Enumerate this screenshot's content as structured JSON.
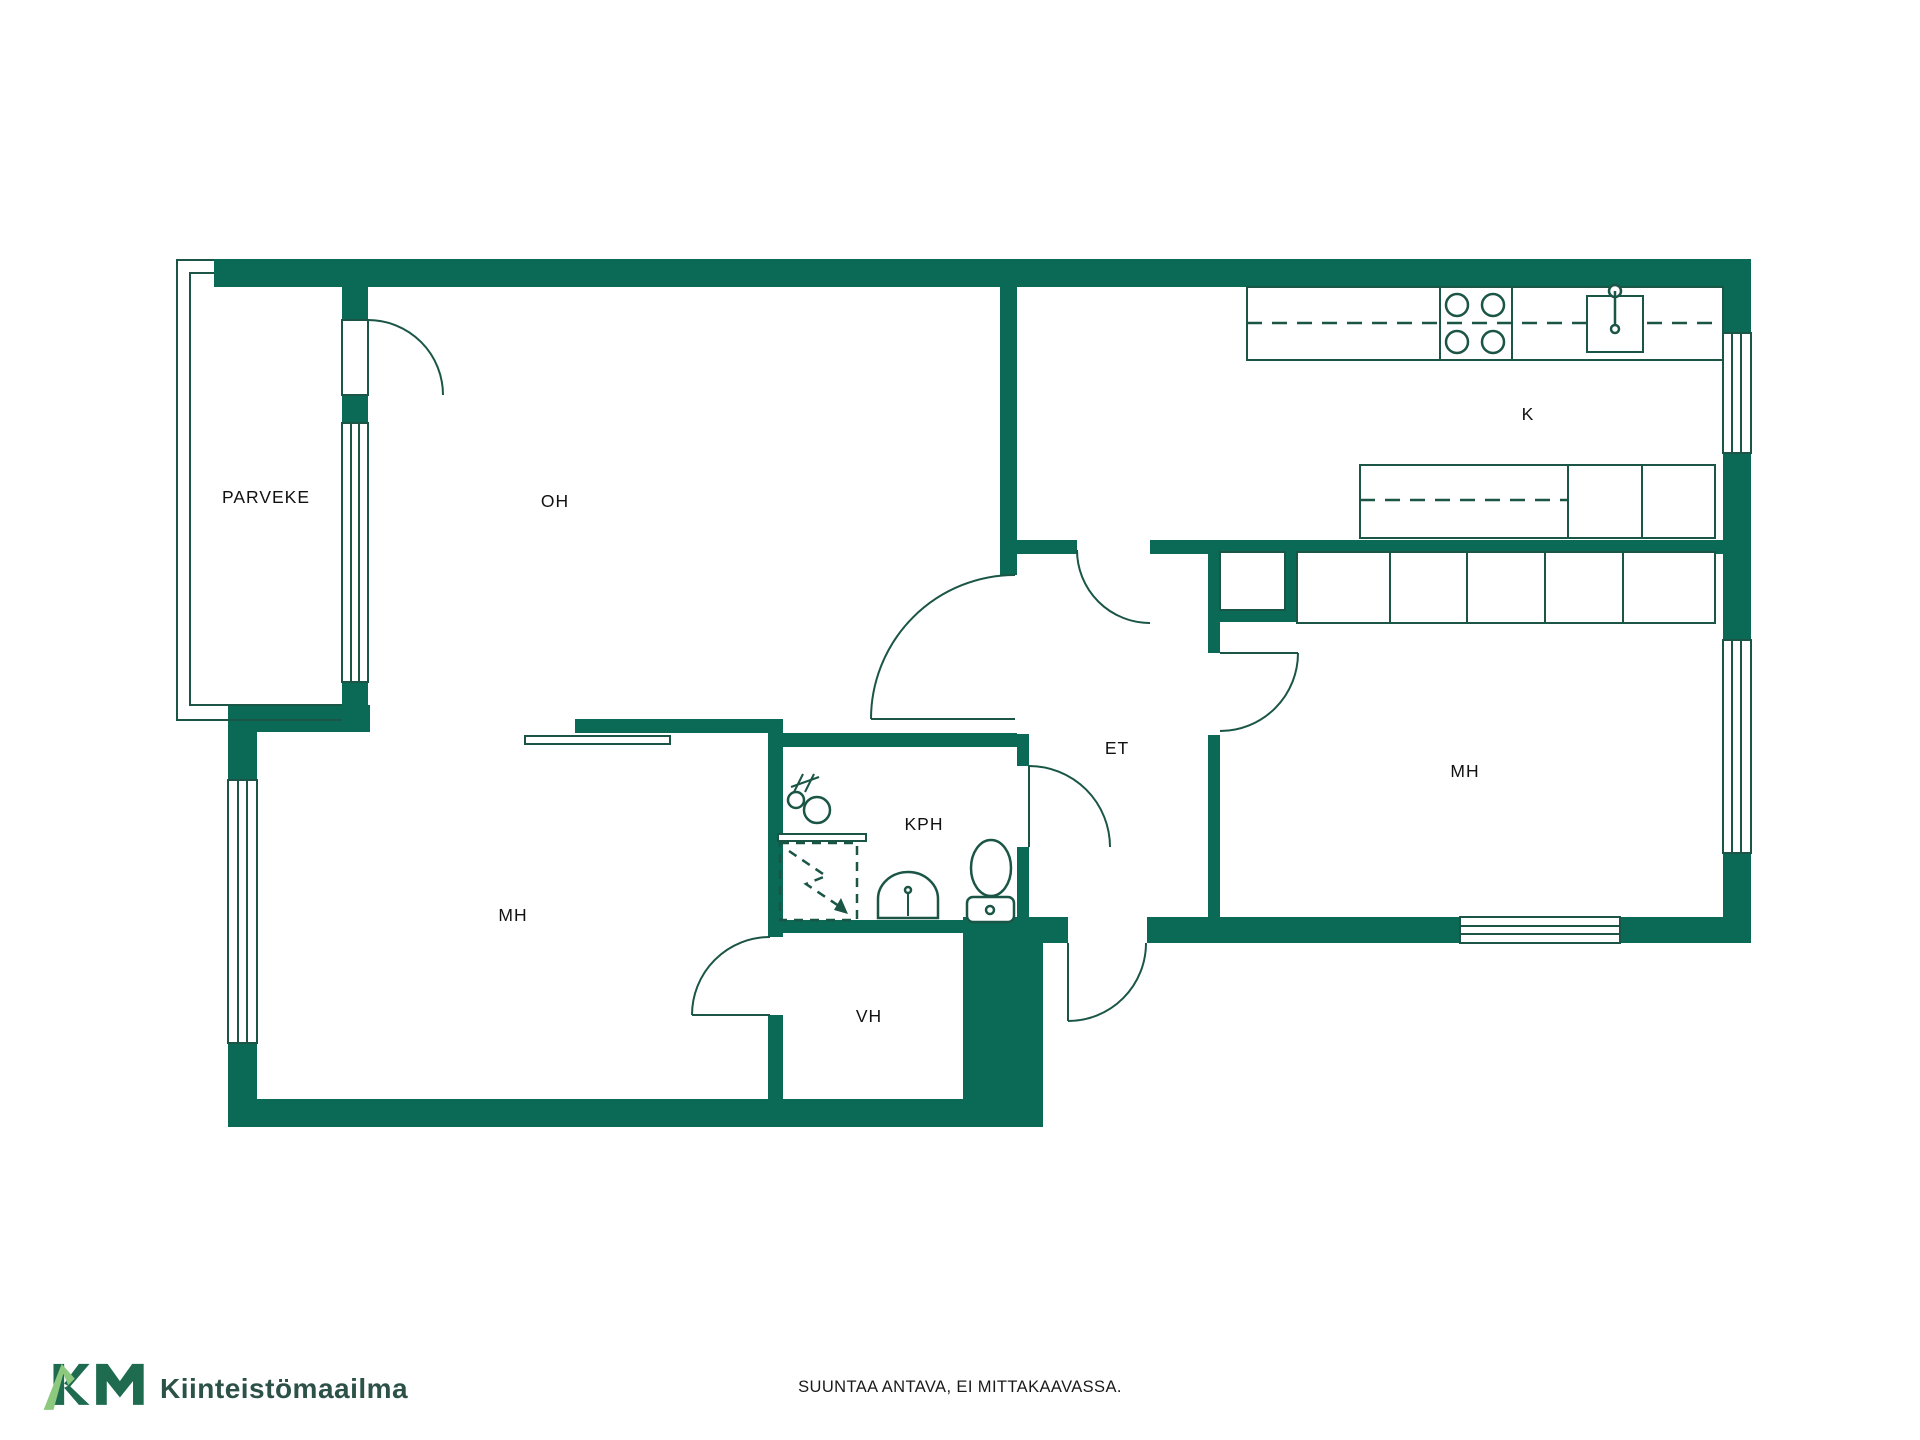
{
  "colors": {
    "wall": "#0b6a56",
    "line": "#1a5546",
    "label": "#111111",
    "logo_dark": "#1e6b4f",
    "logo_light": "#8cc97e",
    "logo_text": "#2c5247",
    "disclaimer_text": "#1a1a1a"
  },
  "rooms": {
    "parveke": "PARVEKE",
    "oh": "OH",
    "k": "K",
    "et": "ET",
    "kph": "KPH",
    "mh_left": "MH",
    "vh": "VH",
    "mh_right": "MH"
  },
  "footer": {
    "brand": "Kiinteistömaailma",
    "disclaimer": "SUUNTAA ANTAVA, EI MITTAKAAVASSA."
  }
}
